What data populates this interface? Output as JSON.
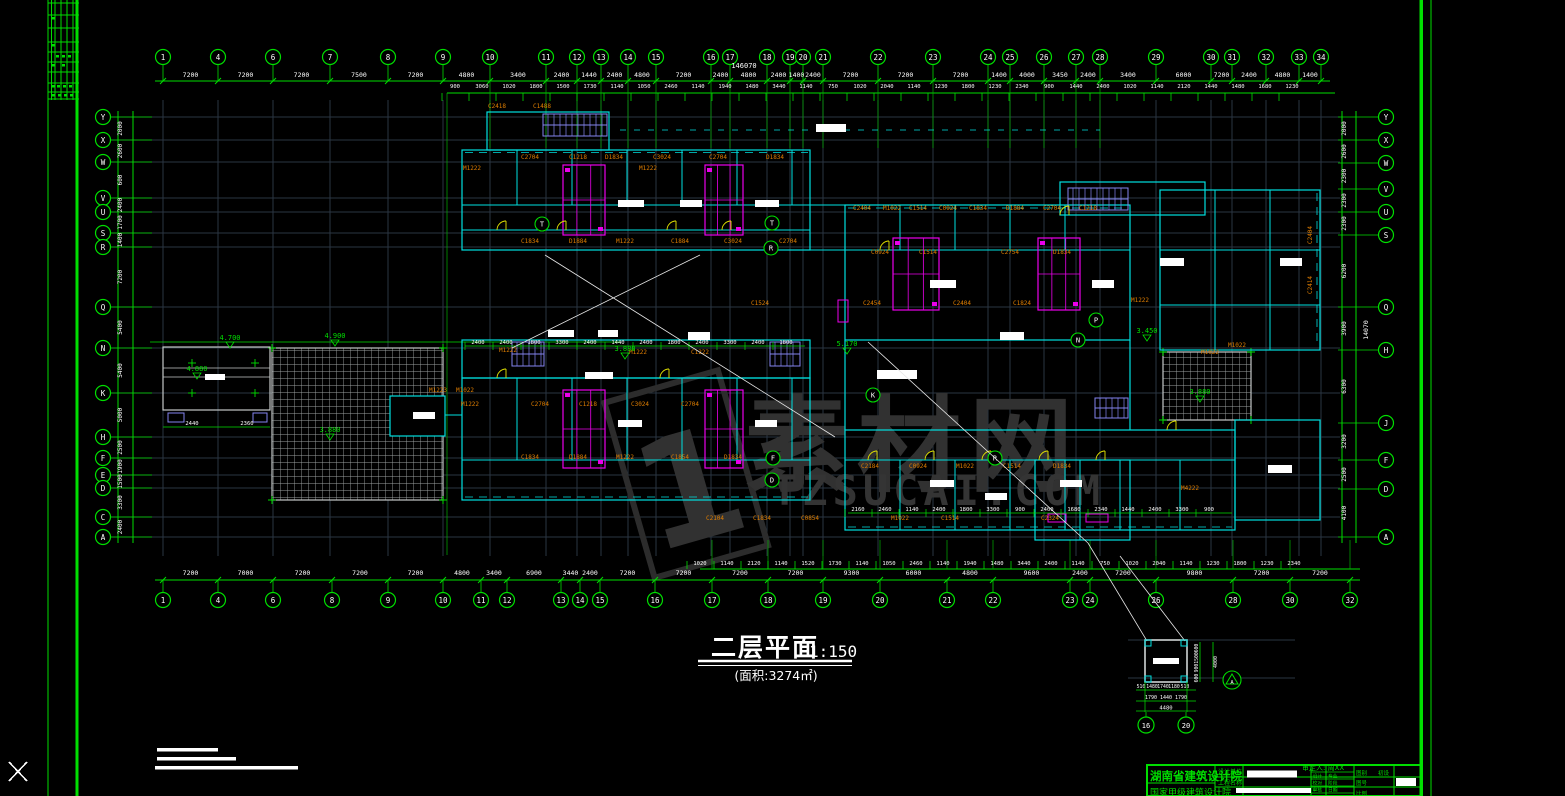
{
  "colors": {
    "green": "#00DE00",
    "bright_green": "#1CFF1C",
    "cyan": "#00DFDF",
    "magenta": "#EB00EB",
    "orange": "#E07E00",
    "yellow": "#E6E600",
    "violet": "#8585F0",
    "slate": "#2A3642",
    "gray": "#C4C8C8",
    "white": "#FFFFFF",
    "watermark": "#313131"
  },
  "watermark": {
    "logo": "1",
    "cjk": "素材网",
    "domain": "TZSUCAI.COM"
  },
  "title": {
    "main": "二层平面",
    "scale": "1:150",
    "area": "(面积:3274㎡)"
  },
  "approver": "审定人: 周XX",
  "titleblock": {
    "institute": "湖南省建筑设计院",
    "subline": "国家甲级建筑设计院",
    "rows": [
      "设计单位",
      "工程名称"
    ],
    "cells_a": [
      "设计",
      "校对",
      "审核"
    ],
    "cells_b": [
      "专业",
      "阶段",
      "日期"
    ],
    "cells_c": [
      "图别",
      "图号"
    ],
    "stage": "初设",
    "scale_label": "比例"
  },
  "axes": {
    "top": {
      "y_circle": 57,
      "y_dim": 77,
      "y_small": 88,
      "circles_x": [
        163,
        218,
        273,
        330,
        388,
        443,
        490,
        546,
        577,
        601,
        628,
        656,
        711,
        730,
        767,
        790,
        803,
        823,
        878,
        933,
        988,
        1010,
        1044,
        1076,
        1100,
        1156,
        1211,
        1232,
        1266,
        1299,
        1321
      ],
      "circles_n": [
        "1",
        "4",
        "6",
        "7",
        "8",
        "9",
        "10",
        "11",
        "12",
        "13",
        "14",
        "15",
        "16",
        "17",
        "18",
        "19",
        "20",
        "21",
        "22",
        "23",
        "24",
        "25",
        "26",
        "27",
        "28",
        "29",
        "30",
        "31",
        "32",
        "33",
        "34"
      ],
      "dims": [
        "7200",
        "7200",
        "7200",
        "7500",
        "7200",
        "4800",
        "3400",
        "2400",
        "1440",
        "2400",
        "4800",
        "7200",
        "2400",
        "4800",
        "2400",
        "1400",
        "2400",
        "7200",
        "7200",
        "7200",
        "1400",
        "4000",
        "3450",
        "2400",
        "3400",
        "6000",
        "7200",
        "2400",
        "4800",
        "1400"
      ],
      "total": "146070",
      "small": [
        "900",
        "3060",
        "1020",
        "1800",
        "1500",
        "1730",
        "1140",
        "1050",
        "2460",
        "1140",
        "1940",
        "1480",
        "3440",
        "1140",
        "750",
        "1020",
        "2040",
        "1140",
        "1230",
        "1800",
        "1230",
        "2340",
        "900",
        "1440",
        "2400",
        "1020",
        "1140",
        "2120",
        "1440",
        "1480",
        "1680",
        "1230"
      ]
    },
    "bottom": {
      "y_circle": 600,
      "y_dim": 575,
      "y_small": 565,
      "circles_x": [
        163,
        218,
        273,
        332,
        388,
        443,
        481,
        507,
        561,
        580,
        600,
        655,
        712,
        768,
        823,
        880,
        947,
        993,
        1070,
        1090,
        1156,
        1233,
        1290,
        1350
      ],
      "circles_n": [
        "1",
        "4",
        "6",
        "8",
        "9",
        "10",
        "11",
        "12",
        "13",
        "14",
        "15",
        "16",
        "17",
        "18",
        "19",
        "20",
        "21",
        "22",
        "23",
        "24",
        "26",
        "28",
        "30",
        "32"
      ],
      "dims": [
        "7200",
        "7000",
        "7200",
        "7200",
        "7200",
        "4800",
        "3400",
        "6900",
        "3440",
        "2400",
        "7200",
        "7200",
        "7200",
        "7200",
        "9300",
        "6000",
        "4800",
        "9600",
        "2400",
        "7200",
        "9800",
        "7200",
        "7200"
      ],
      "small": [
        "1020",
        "1140",
        "2120",
        "1140",
        "1520",
        "1730",
        "1140",
        "1050",
        "2460",
        "1140",
        "1940",
        "1480",
        "3440",
        "2400",
        "1140",
        "750",
        "1020",
        "2040",
        "1140",
        "1230",
        "1800",
        "1230",
        "2340"
      ]
    },
    "left": {
      "x_circle": 103,
      "circles": [
        [
          117,
          "Y"
        ],
        [
          140,
          "X"
        ],
        [
          162,
          "W"
        ],
        [
          198,
          "V"
        ],
        [
          212,
          "U"
        ],
        [
          233,
          "S"
        ],
        [
          247,
          "R"
        ],
        [
          307,
          "Q"
        ],
        [
          348,
          "N"
        ],
        [
          393,
          "K"
        ],
        [
          437,
          "H"
        ],
        [
          458,
          "F"
        ],
        [
          475,
          "E"
        ],
        [
          488,
          "D"
        ],
        [
          517,
          "C"
        ],
        [
          537,
          "A"
        ]
      ],
      "dims": [
        "2000",
        "2600",
        "600",
        "2400",
        "1700",
        "1400",
        "7200",
        "5400",
        "5400",
        "5000",
        "2500",
        "1900",
        "1500",
        "3300",
        "2400"
      ]
    },
    "right": {
      "x_circle": 1386,
      "circles": [
        [
          117,
          "Y"
        ],
        [
          140,
          "X"
        ],
        [
          163,
          "W"
        ],
        [
          189,
          "V"
        ],
        [
          212,
          "U"
        ],
        [
          235,
          "S"
        ],
        [
          307,
          "Q"
        ],
        [
          350,
          "H"
        ],
        [
          423,
          "J"
        ],
        [
          460,
          "F"
        ],
        [
          489,
          "D"
        ],
        [
          537,
          "A"
        ]
      ],
      "dims": [
        "2000",
        "2600",
        "2300",
        "2300",
        "2300",
        "6200",
        "3900",
        "6300",
        "3200",
        "2500",
        "4100"
      ],
      "total": "14070"
    }
  },
  "plan": {
    "orange_labels": [
      [
        472,
        170,
        "M1222"
      ],
      [
        530,
        159,
        "C2704"
      ],
      [
        578,
        159,
        "C1218"
      ],
      [
        614,
        159,
        "D1834"
      ],
      [
        662,
        159,
        "C3024"
      ],
      [
        718,
        159,
        "C2704"
      ],
      [
        775,
        159,
        "D1834"
      ],
      [
        648,
        170,
        "M1222"
      ],
      [
        497,
        108,
        "C2418"
      ],
      [
        542,
        108,
        "C1488"
      ],
      [
        862,
        210,
        "C2404"
      ],
      [
        892,
        210,
        "M1022"
      ],
      [
        918,
        210,
        "C1514"
      ],
      [
        948,
        210,
        "C0924"
      ],
      [
        978,
        210,
        "C1834"
      ],
      [
        1015,
        210,
        "D1884"
      ],
      [
        1052,
        210,
        "C2704"
      ],
      [
        1088,
        210,
        "C1218"
      ],
      [
        530,
        243,
        "C1834"
      ],
      [
        578,
        243,
        "D1884"
      ],
      [
        625,
        243,
        "M1222"
      ],
      [
        680,
        243,
        "C1884"
      ],
      [
        733,
        243,
        "C3024"
      ],
      [
        788,
        243,
        "C2704"
      ],
      [
        880,
        254,
        "C0924"
      ],
      [
        928,
        254,
        "C1514"
      ],
      [
        1010,
        254,
        "C2754"
      ],
      [
        1062,
        254,
        "D1834"
      ],
      [
        760,
        305,
        "C1524"
      ],
      [
        872,
        305,
        "C2454"
      ],
      [
        962,
        305,
        "C2404"
      ],
      [
        1022,
        305,
        "C1824"
      ],
      [
        1140,
        302,
        "M1222"
      ],
      [
        638,
        354,
        "M1222"
      ],
      [
        700,
        354,
        "C1222"
      ],
      [
        1210,
        354,
        "M1022"
      ],
      [
        508,
        352,
        "M1222"
      ],
      [
        438,
        392,
        "M1223"
      ],
      [
        465,
        392,
        "M1022"
      ],
      [
        470,
        406,
        "M1222"
      ],
      [
        540,
        406,
        "C2704"
      ],
      [
        588,
        406,
        "C1218"
      ],
      [
        640,
        406,
        "C3024"
      ],
      [
        690,
        406,
        "C2704"
      ],
      [
        530,
        459,
        "C1834"
      ],
      [
        578,
        459,
        "D1884"
      ],
      [
        625,
        459,
        "M1222"
      ],
      [
        680,
        459,
        "C1854"
      ],
      [
        733,
        459,
        "D1834"
      ],
      [
        870,
        468,
        "C2184"
      ],
      [
        918,
        468,
        "C0924"
      ],
      [
        965,
        468,
        "M1022"
      ],
      [
        1012,
        468,
        "C1514"
      ],
      [
        1062,
        468,
        "D1834"
      ],
      [
        715,
        520,
        "C2104"
      ],
      [
        762,
        520,
        "C1834"
      ],
      [
        810,
        520,
        "C0854"
      ],
      [
        900,
        520,
        "M1022"
      ],
      [
        950,
        520,
        "C1514"
      ],
      [
        1050,
        520,
        "C2324"
      ],
      [
        1190,
        490,
        "M4222"
      ],
      [
        1237,
        347,
        "M1022"
      ]
    ],
    "orange_rot": [
      [
        1312,
        235,
        "C2404"
      ],
      [
        1312,
        285,
        "C2414"
      ]
    ],
    "levels": [
      [
        230,
        340,
        "4.700"
      ],
      [
        335,
        338,
        "4.900"
      ],
      [
        197,
        371,
        "4.880"
      ],
      [
        330,
        432,
        "3.880"
      ],
      [
        1200,
        394,
        "3.880"
      ],
      [
        625,
        351,
        "3.880"
      ],
      [
        847,
        346,
        "5.170"
      ],
      [
        1147,
        333,
        "3.450"
      ]
    ],
    "letter_circles": [
      [
        542,
        224,
        "T"
      ],
      [
        772,
        223,
        "T"
      ],
      [
        771,
        248,
        "R"
      ],
      [
        873,
        395,
        "K"
      ],
      [
        773,
        458,
        "F"
      ],
      [
        772,
        480,
        "D"
      ],
      [
        1096,
        320,
        "P"
      ],
      [
        1078,
        340,
        "N"
      ],
      [
        995,
        458,
        "R"
      ]
    ],
    "terrace_dims": [
      "2440",
      "2360"
    ],
    "interior_rowA": [
      "2160",
      "2460",
      "1140",
      "2400",
      "1800",
      "3300",
      "900",
      "2400",
      "1680",
      "2340",
      "1440",
      "2400",
      "3300",
      "900"
    ],
    "interior_rowB": [
      "2400",
      "2400",
      "1800",
      "3300",
      "2400",
      "1440",
      "2400",
      "1800",
      "2400",
      "3300",
      "2400",
      "1800"
    ]
  },
  "detail": {
    "dims_row1": [
      "510",
      "1480",
      "1740",
      "1180",
      "510"
    ],
    "dims_row2": [
      "1790",
      "1440",
      "1790"
    ],
    "total": "4480",
    "vchain": [
      "600",
      "1500",
      "900",
      "600"
    ],
    "vtotal": "4000",
    "circles": [
      "16",
      "20"
    ],
    "marker": "A"
  }
}
